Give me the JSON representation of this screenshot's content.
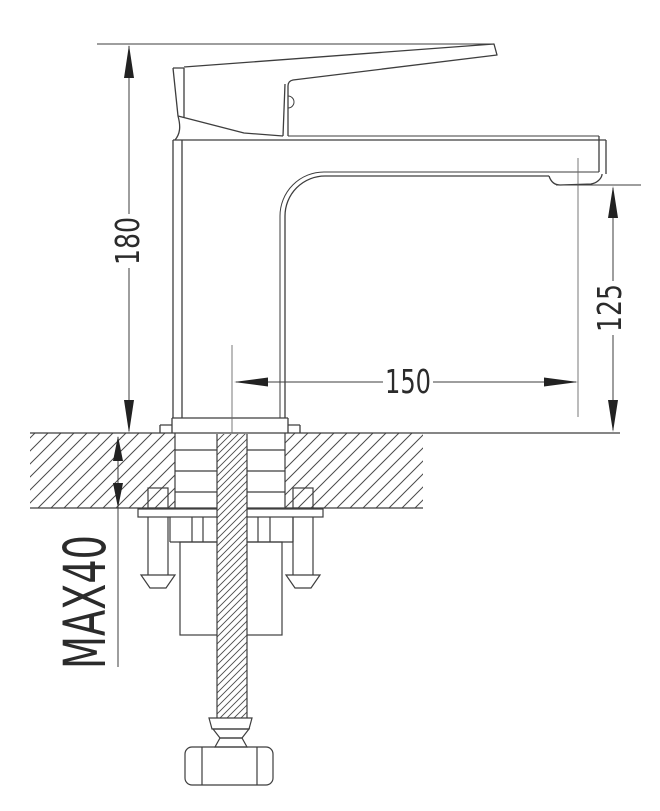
{
  "page": {
    "background_color": "#ffffff",
    "line_color": "#3e3e3e",
    "text_color": "#2b2b2b"
  },
  "drawing": {
    "type": "technical-drawing",
    "subject": "Single-lever basin mixer faucet, side elevation with deck mounting cross-section",
    "dimensions": {
      "overall_height": "180",
      "spout_height": "125",
      "spout_reach": "150",
      "max_deck_thickness": "MAX40"
    }
  }
}
